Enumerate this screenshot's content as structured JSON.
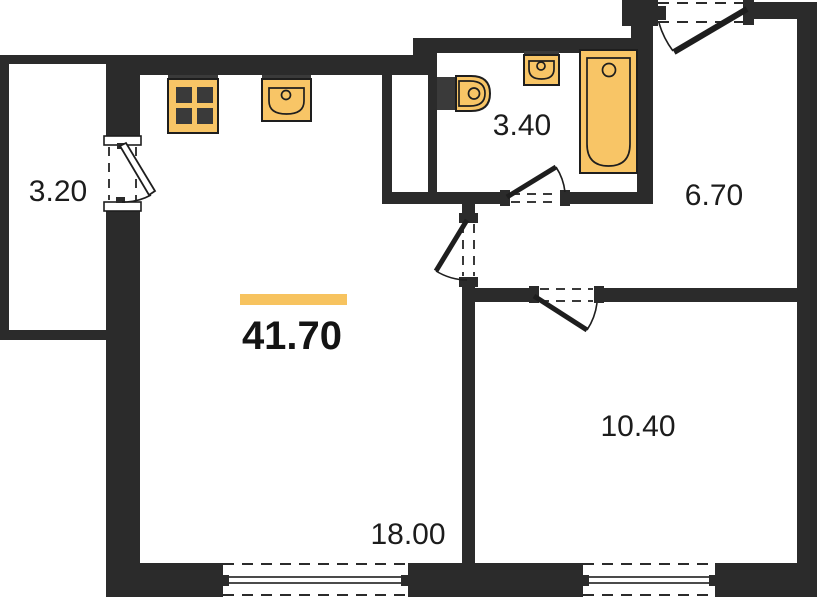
{
  "plan": {
    "type": "apartment-floor-plan",
    "total_area_label": "41.70",
    "labels": {
      "balcony": "3.20",
      "bathroom": "3.40",
      "hallway": "6.70",
      "bedroom": "10.40",
      "living_kitchen": "18.00",
      "total": "41.70"
    },
    "fixtures": [
      "stove-icon",
      "kitchen-sink-icon",
      "toilet-icon",
      "washbasin-icon",
      "bathtub-icon"
    ],
    "colors": {
      "wall": "#2b2b2b",
      "fixture_fill": "#F8C566",
      "highlight_bar": "#F7C35F",
      "burner": "#3a3a3a",
      "text": "#1c1c1c",
      "background": "#ffffff"
    }
  }
}
